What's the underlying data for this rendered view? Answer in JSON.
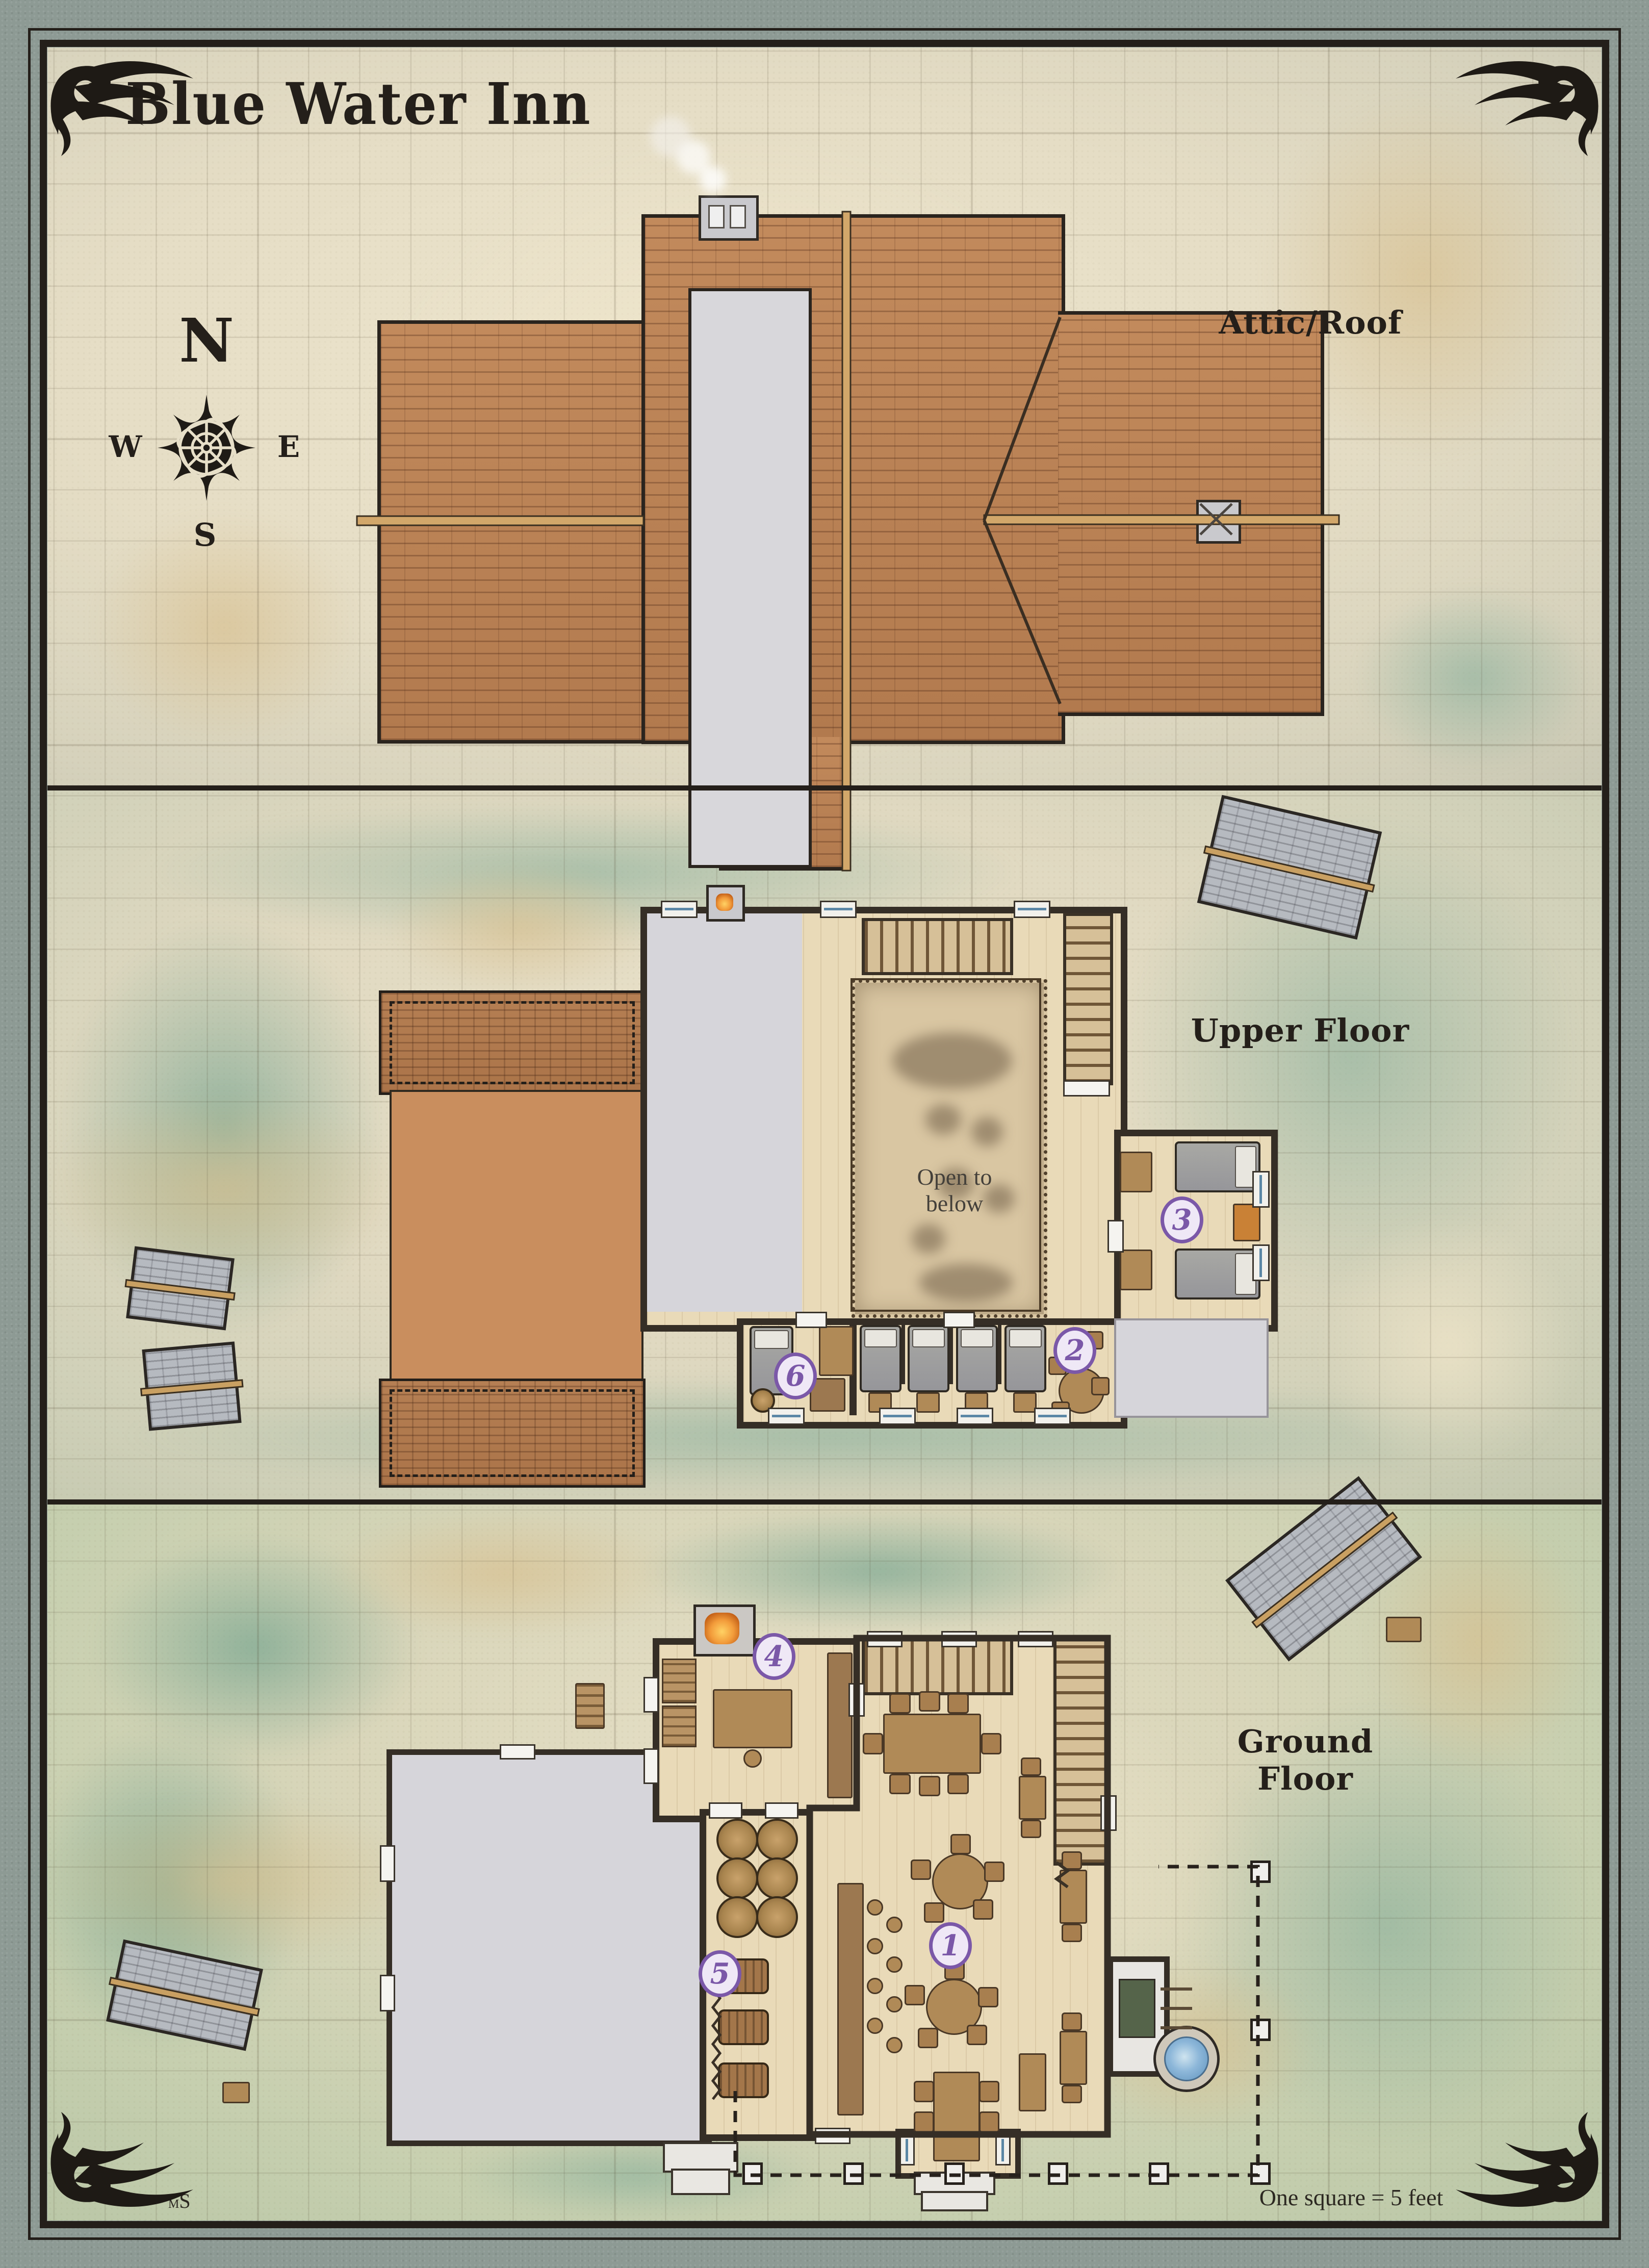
{
  "title": "Blue Water Inn",
  "compass": {
    "north": "N",
    "east": "E",
    "south": "S",
    "west": "W"
  },
  "panels": {
    "attic": {
      "label": "Attic/Roof"
    },
    "upper": {
      "label": "Upper Floor",
      "open_label": "Open to below"
    },
    "ground": {
      "label": "Ground Floor"
    }
  },
  "badges": [
    {
      "number": "1"
    },
    {
      "number": "2"
    },
    {
      "number": "3"
    },
    {
      "number": "4"
    },
    {
      "number": "5"
    },
    {
      "number": "6"
    }
  ],
  "scale_note": "One square = 5 feet",
  "signature": {
    "small": "M",
    "large": "S"
  },
  "colors": {
    "ink": "#241f1a",
    "parchment": "#e7dfc8",
    "grass": "#b9ceb3",
    "roof_shingle": "#bb8257",
    "roof_flat": "#c98e5e",
    "stone_margin": "#8e9a93",
    "wall": "#352e26",
    "water": "#8db7d9",
    "wood_floor": "#e9dab8",
    "flat_gray": "#d6d5da",
    "badge_purple": "#7b58a8",
    "badge_fill": "#efe8f6"
  },
  "icons": {
    "compass_rose": "8-point star rose",
    "corner_flourish": "winged scroll",
    "chimney": "smoking chimney",
    "hearth": "lit hearth",
    "fountain": "stone fountain",
    "fence_post": "square post",
    "stairs": "tread steps"
  }
}
